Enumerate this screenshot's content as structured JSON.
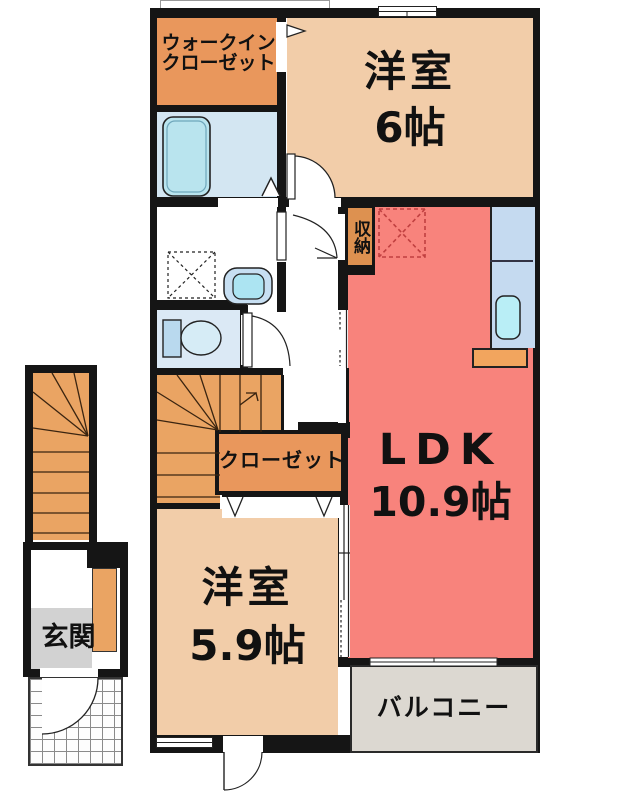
{
  "floorplan": {
    "type": "apartment-floor-plan",
    "rooms": {
      "walk_in_closet": {
        "label_line1": "ウォークイン",
        "label_line2": "クローゼット"
      },
      "bedroom6": {
        "name": "洋室",
        "size": "6帖"
      },
      "storage": {
        "label": "収納"
      },
      "ldk": {
        "name": "LDK",
        "size": "10.9帖"
      },
      "closet": {
        "label": "クローゼット"
      },
      "bedroom59": {
        "name": "洋室",
        "size": "5.9帖"
      },
      "balcony": {
        "label": "バルコニー"
      },
      "entrance": {
        "label": "玄関"
      }
    },
    "colors": {
      "wall": "#151515",
      "closet_orange": "#e9975c",
      "bedroom_beige": "#f2cda9",
      "ldk_salmon": "#f8837c",
      "kitchen_blue": "#c5daf0",
      "bath_blue": "#d3e6f2",
      "toilet_blue": "#dbe9f5",
      "stairs_orange": "#eaa463",
      "entrance_gray": "#d2d2d2",
      "balcony_gray": "#dcd8d1",
      "counter_orange": "#f2a55e",
      "fixture_cyan": "#b9e4ee",
      "fridge_dash_red": "#c04040"
    }
  }
}
